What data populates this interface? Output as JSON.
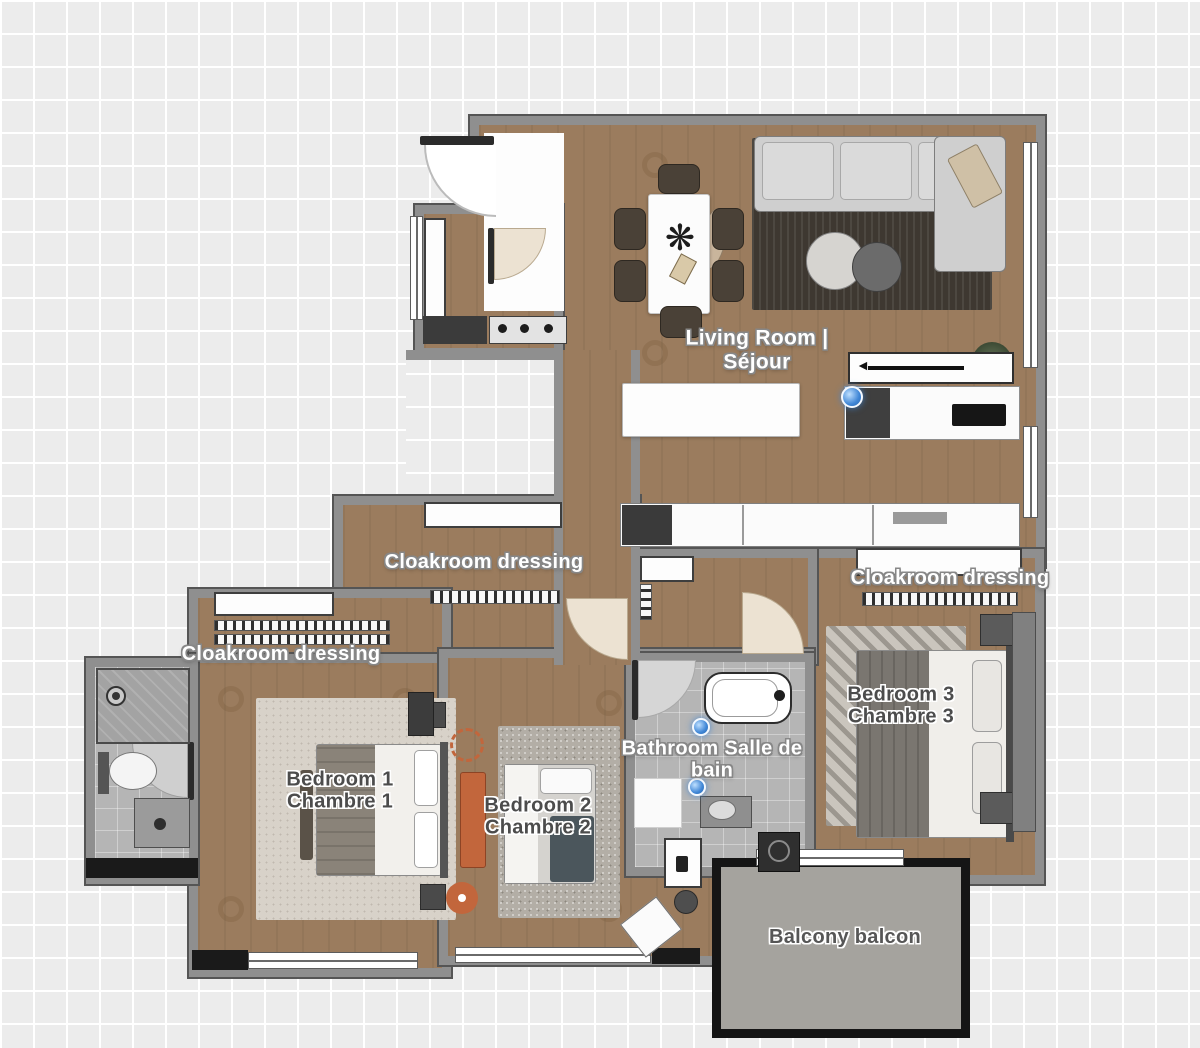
{
  "plan": {
    "rooms": {
      "living_room": {
        "line1": "Living Room |",
        "line2": "Séjour"
      },
      "cloakroom_left": {
        "label": "Cloakroom dressing"
      },
      "cloakroom_middle": {
        "label": "Cloakroom dressing"
      },
      "cloakroom_right": {
        "label": "Cloakroom dressing"
      },
      "bedroom_1": {
        "line1": "Bedroom 1",
        "line2": "Chambre 1"
      },
      "bedroom_2": {
        "line1": "Bedroom 2",
        "line2": "Chambre 2"
      },
      "bedroom_3": {
        "line1": "Bedroom 3",
        "line2": "Chambre 3"
      },
      "bathroom": {
        "line1": "Bathroom Salle de",
        "line2": "bain"
      },
      "balcony": {
        "label": "Balcony balcon"
      }
    },
    "colors": {
      "canvas_background": "#ececec",
      "grid_line": "#ffffff",
      "wall_fill": "#8f8f8f",
      "wall_edge": "#555555",
      "wood_floor": "#9b7c5e",
      "tile_floor": "#b5b5b5",
      "balcony_floor": "#a5a39e",
      "balcony_border": "#151515",
      "rug_dark": "#3e3831",
      "accent_orange": "#c2663c",
      "marker_blue": "#3f86d6",
      "label_light": "#ffffff",
      "label_dark": "#4c4c4c"
    }
  }
}
